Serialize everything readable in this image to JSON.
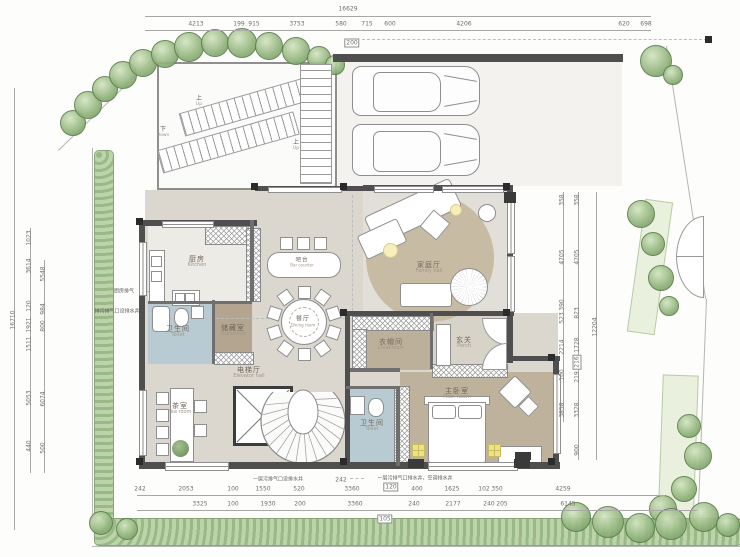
{
  "rooms": {
    "kitchen": {
      "zh": "厨房",
      "en": "Kitchen"
    },
    "toilet1": {
      "zh": "卫生间",
      "en": "Toilet"
    },
    "storeroom": {
      "zh": "储藏室",
      "en": "Storeroom"
    },
    "bar": {
      "zh": "吧台",
      "en": "Bar counter"
    },
    "dining": {
      "zh": "餐厅",
      "en": "Dining room"
    },
    "family": {
      "zh": "家庭厅",
      "en": "Family hall"
    },
    "elevator": {
      "zh": "电梯厅",
      "en": "Elevator hall"
    },
    "tea": {
      "zh": "茶室",
      "en": "Tea room"
    },
    "cloakroom": {
      "zh": "衣帽间",
      "en": "Cloakroom"
    },
    "porch": {
      "zh": "玄关",
      "en": "Porch"
    },
    "master": {
      "zh": "主卧室",
      "en": "Mstr. Room"
    },
    "toilet2": {
      "zh": "卫生间",
      "en": "Toilet"
    }
  },
  "stairs": {
    "down": "下",
    "down_en": "Down",
    "up": "上",
    "up_en": "Up"
  },
  "dims": {
    "top_total": "16629",
    "top_row": [
      "4213",
      "199",
      "915",
      "3753",
      "580",
      "715",
      "600",
      "4206",
      "620",
      "698"
    ],
    "top_boxed": "200",
    "left_total": "16710",
    "left_a": [
      "1023",
      "3614",
      "120",
      "1921",
      "1511",
      "5053",
      "440"
    ],
    "left_b": [
      "5548",
      "984",
      "800",
      "6074",
      "500"
    ],
    "right_a": [
      "358",
      "4705",
      "390",
      "523",
      "2214",
      "100",
      "3858"
    ],
    "right_b": [
      "358",
      "4705",
      "823",
      "1728",
      "216",
      "219",
      "3328",
      "900"
    ],
    "right_total": "12204",
    "bottom_a": [
      "242",
      "2053",
      "100",
      "1550",
      "520",
      "3360",
      "400",
      "1625",
      "102",
      "350",
      "4259"
    ],
    "bottom_b": [
      "3325",
      "100",
      "1930",
      "200",
      "3360",
      "240",
      "2177",
      "240",
      "205",
      "6145"
    ],
    "bottom_boxed": "105",
    "note_242": "242",
    "note_120": "120"
  },
  "notes": {
    "kitchen_vent": "厨房排气",
    "drain_left": "排污排气口设排水井",
    "drain_mid": "一层污排气口设排水井",
    "drain_right": "一层污排气口排水井，空调排水井"
  },
  "colors": {
    "wall": "#4f4f4f",
    "floor": "#dbd7cf",
    "family_rug": "#c8bba4",
    "bedroom_floor": "#bfb29c",
    "bathroom_floor": "#b9cbd2",
    "storeroom_floor": "#b3a58f",
    "landscape_green": "#8fb27a",
    "lamp_yellow": "#ece28a"
  }
}
